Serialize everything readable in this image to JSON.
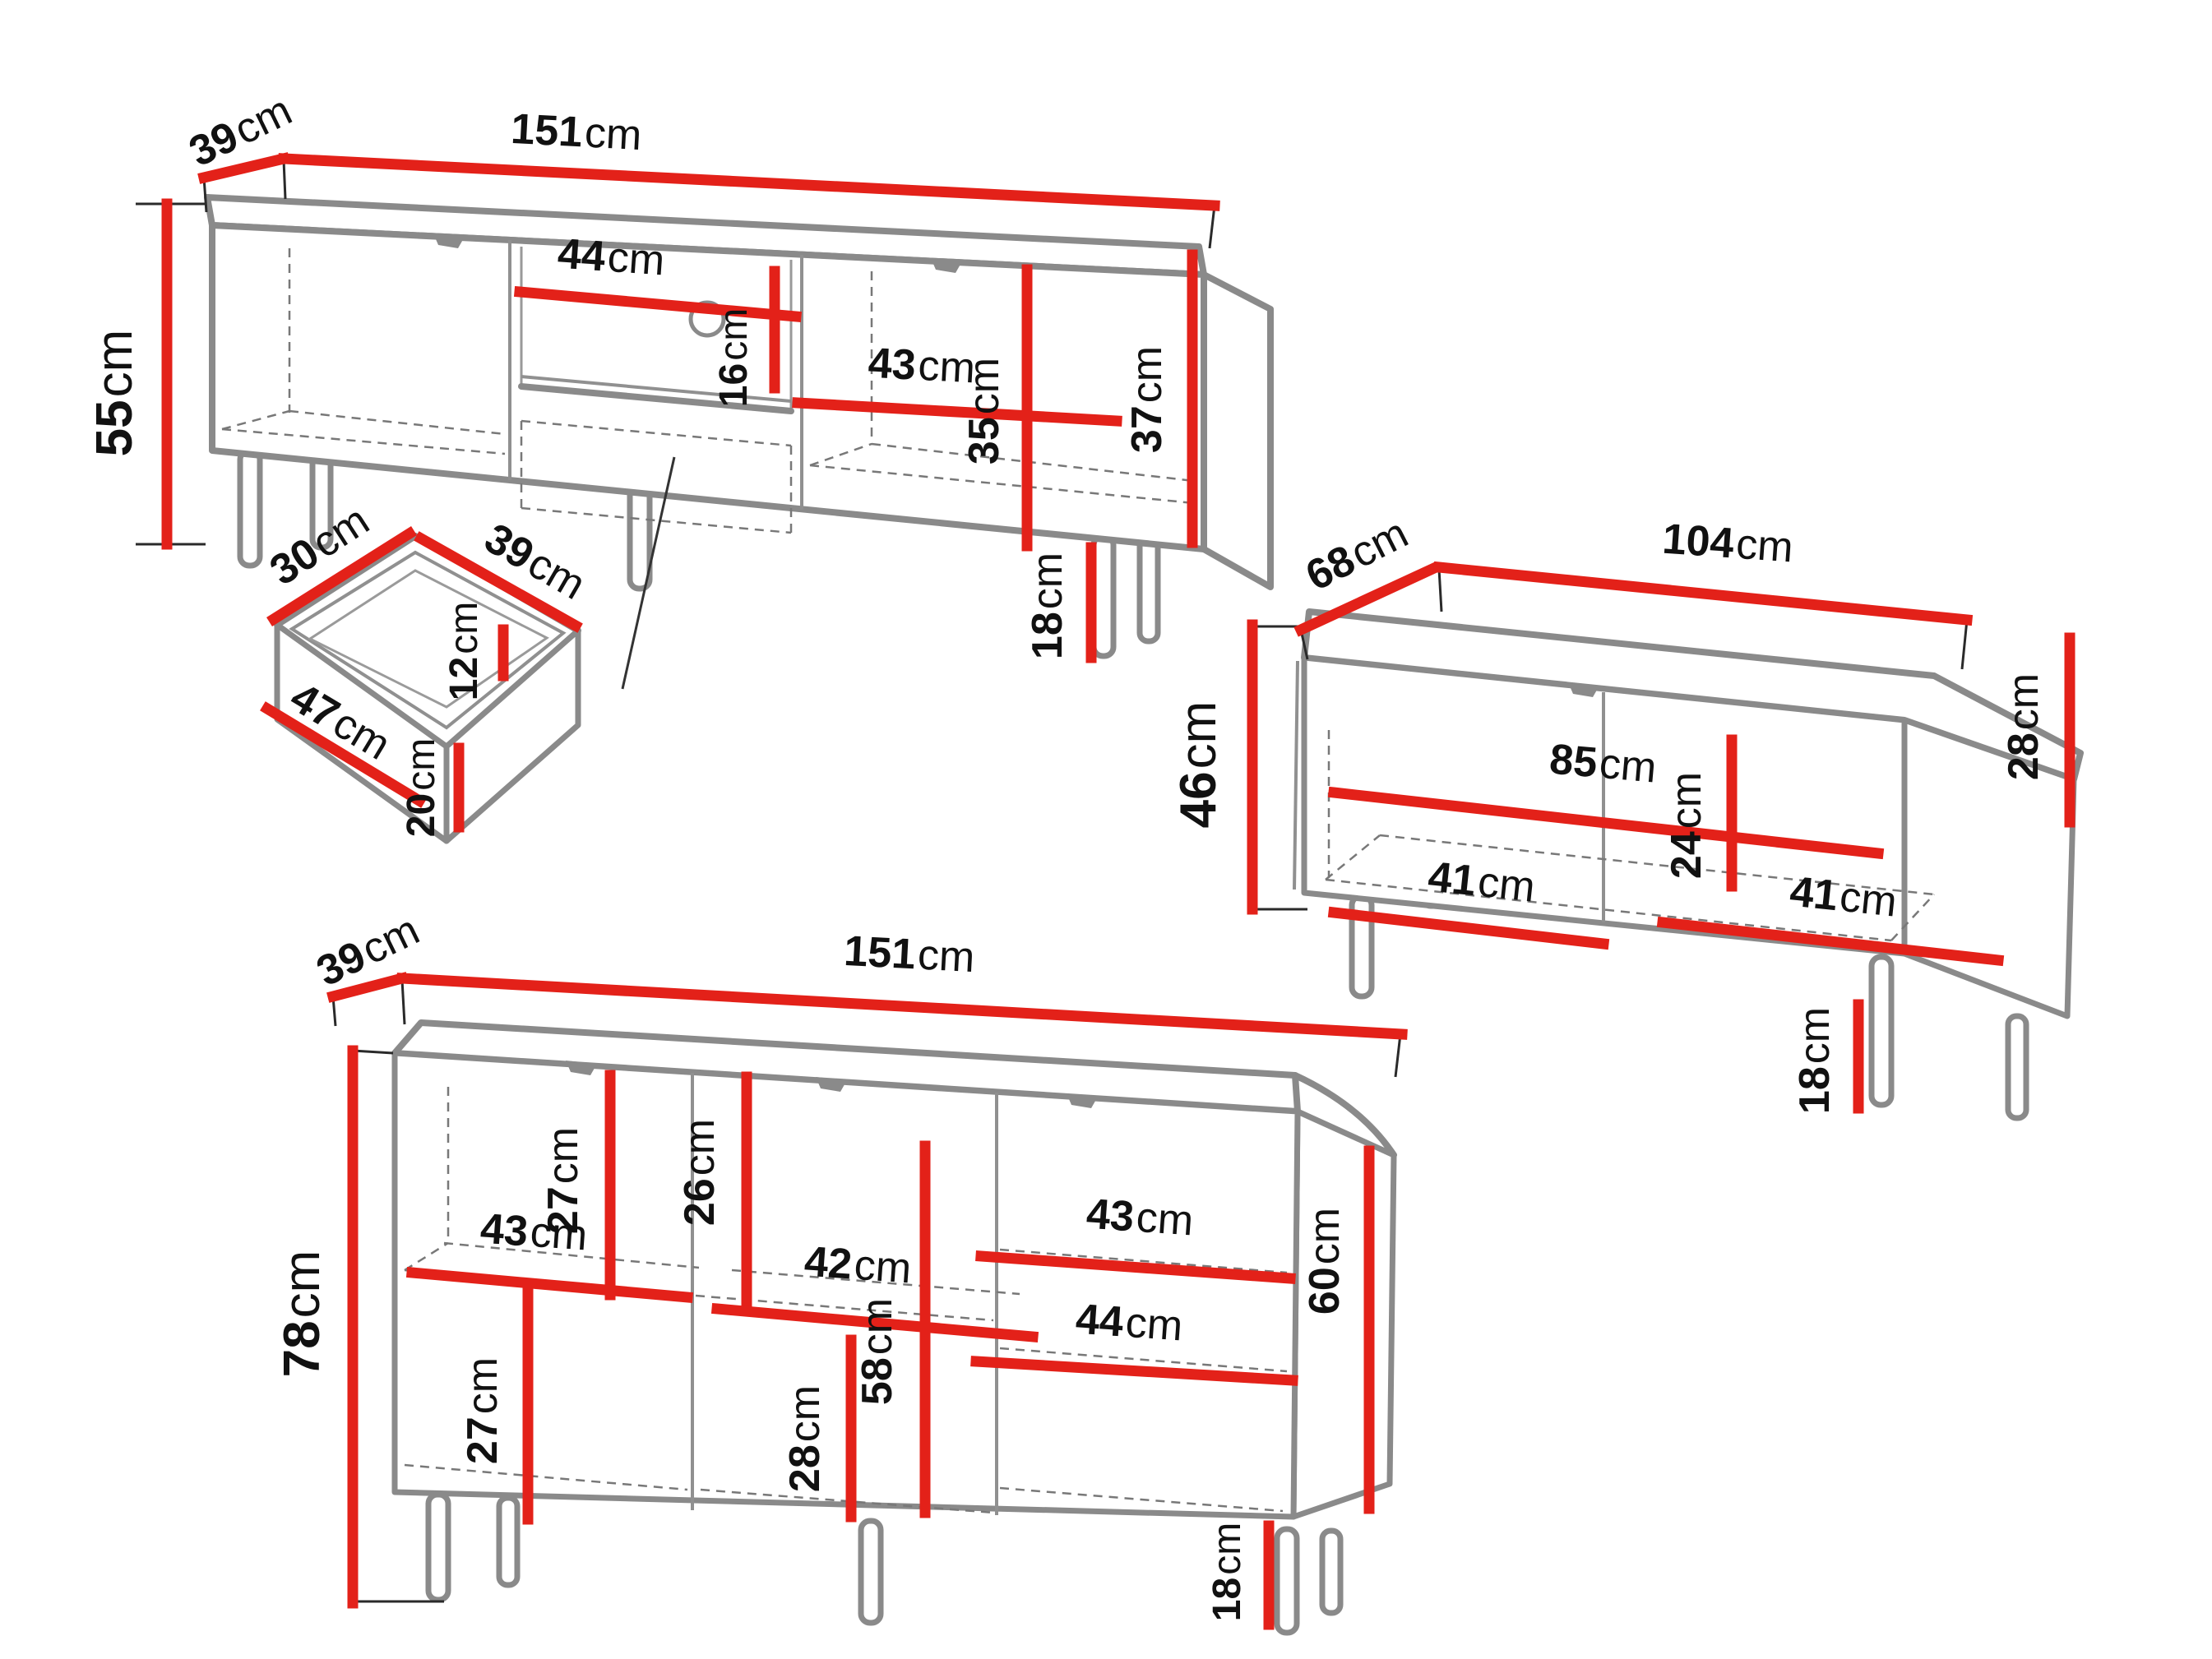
{
  "units": "cm",
  "colors": {
    "dimension_line": "#e32119",
    "outline_gray": "#8a8a8a",
    "hidden_edge_dash": "#787878",
    "label_text": "#111111",
    "background": "#ffffff"
  },
  "pieces": {
    "tv_stand": {
      "name": "TV stand",
      "labels": {
        "depth": {
          "v": "39",
          "u": "cm"
        },
        "width": {
          "v": "151",
          "u": "cm"
        },
        "height": {
          "v": "55",
          "u": "cm"
        },
        "shelf_width": {
          "v": "44",
          "u": "cm"
        },
        "shelf_height": {
          "v": "16",
          "u": "cm"
        },
        "right_section_width": {
          "v": "43",
          "u": "cm"
        },
        "right_section_height": {
          "v": "35",
          "u": "cm"
        },
        "side_inner_height": {
          "v": "37",
          "u": "cm"
        },
        "leg_height": {
          "v": "18",
          "u": "cm"
        }
      }
    },
    "drawer": {
      "name": "drawer detail",
      "labels": {
        "top_depth": {
          "v": "30",
          "u": "cm"
        },
        "top_width": {
          "v": "39",
          "u": "cm"
        },
        "back_height": {
          "v": "12",
          "u": "cm"
        },
        "front_depth": {
          "v": "47",
          "u": "cm"
        },
        "front_height": {
          "v": "20",
          "u": "cm"
        }
      }
    },
    "coffee_table": {
      "name": "coffee table",
      "labels": {
        "depth": {
          "v": "68",
          "u": "cm"
        },
        "width": {
          "v": "104",
          "u": "cm"
        },
        "height": {
          "v": "46",
          "u": "cm"
        },
        "inner_width": {
          "v": "85",
          "u": "cm"
        },
        "shelf_height": {
          "v": "24",
          "u": "cm"
        },
        "left_shelf_width": {
          "v": "41",
          "u": "cm"
        },
        "right_shelf_width": {
          "v": "41",
          "u": "cm"
        },
        "side_inner_height": {
          "v": "28",
          "u": "cm"
        },
        "leg_height": {
          "v": "18",
          "u": "cm"
        }
      }
    },
    "sideboard": {
      "name": "sideboard",
      "labels": {
        "depth": {
          "v": "39",
          "u": "cm"
        },
        "width": {
          "v": "151",
          "u": "cm"
        },
        "height": {
          "v": "78",
          "u": "cm"
        },
        "left_upper_height": {
          "v": "27",
          "u": "cm"
        },
        "left_shelf_width": {
          "v": "43",
          "u": "cm"
        },
        "middle_upper_height": {
          "v": "26",
          "u": "cm"
        },
        "middle_shelf_width": {
          "v": "42",
          "u": "cm"
        },
        "left_lower_height": {
          "v": "27",
          "u": "cm"
        },
        "middle_lower_height": {
          "v": "28",
          "u": "cm"
        },
        "middle_inner_height": {
          "v": "58",
          "u": "cm"
        },
        "right_upper_shelf_width": {
          "v": "43",
          "u": "cm"
        },
        "right_lower_shelf_width": {
          "v": "44",
          "u": "cm"
        },
        "right_inner_height": {
          "v": "60",
          "u": "cm"
        },
        "leg_height": {
          "v": "18",
          "u": "cm"
        }
      }
    }
  }
}
